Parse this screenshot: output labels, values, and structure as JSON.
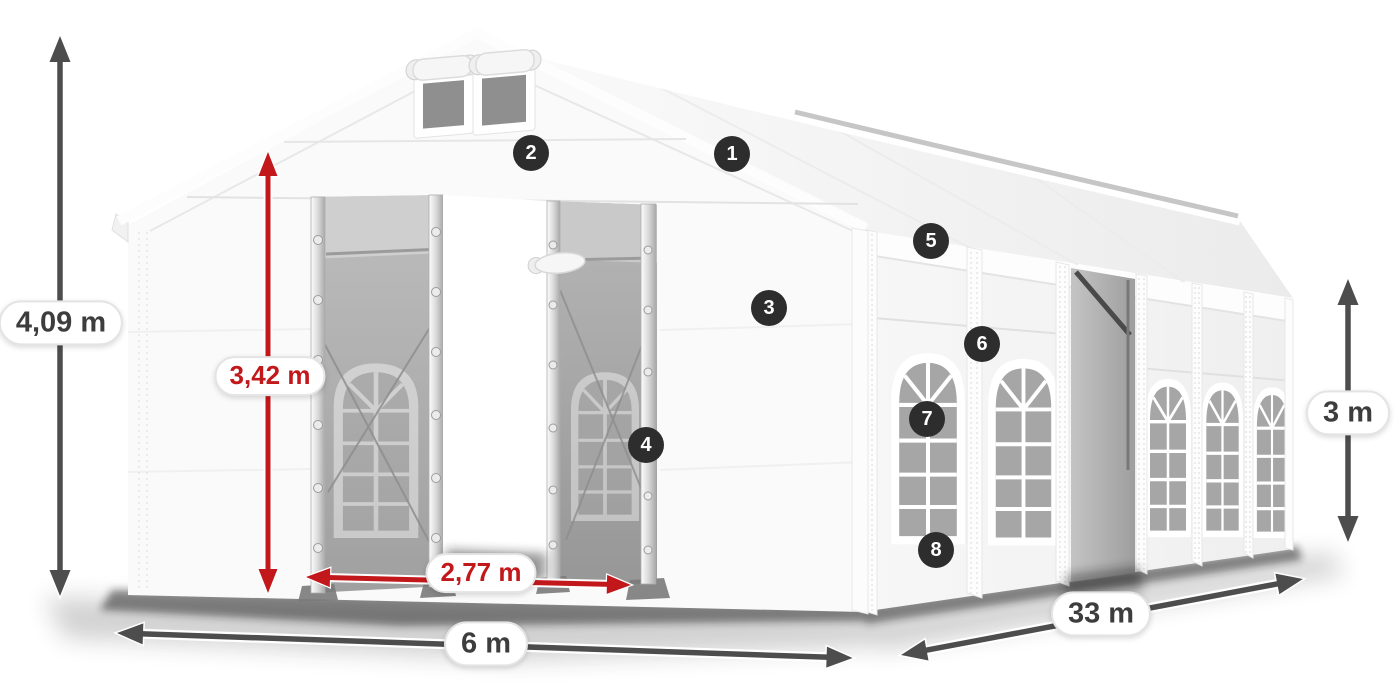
{
  "illustration": {
    "alt": "White marquee party tent shown in perspective with open front entrance doors, arched side windows and an open side section"
  },
  "dimensions": [
    {
      "id": "total-height",
      "label": "4,09 m",
      "style": "gray"
    },
    {
      "id": "entrance-height",
      "label": "3,42 m",
      "style": "red"
    },
    {
      "id": "entrance-width",
      "label": "2,77 m",
      "style": "red"
    },
    {
      "id": "front-width",
      "label": "6 m",
      "style": "gray"
    },
    {
      "id": "side-length",
      "label": "33 m",
      "style": "gray"
    },
    {
      "id": "side-wall-height",
      "label": "3 m",
      "style": "gray"
    }
  ],
  "callouts": [
    {
      "number": "1"
    },
    {
      "number": "2"
    },
    {
      "number": "3"
    },
    {
      "number": "4"
    },
    {
      "number": "5"
    },
    {
      "number": "6"
    },
    {
      "number": "7"
    },
    {
      "number": "8"
    }
  ],
  "colors": {
    "dimension_red": "#c3181b",
    "dimension_gray": "#4d4d4d",
    "badge_background": "#2d2d2d",
    "pill_border": "#e4e4e4",
    "tent_white": "#fafafa",
    "mesh_gray": "#a8a8a8"
  }
}
